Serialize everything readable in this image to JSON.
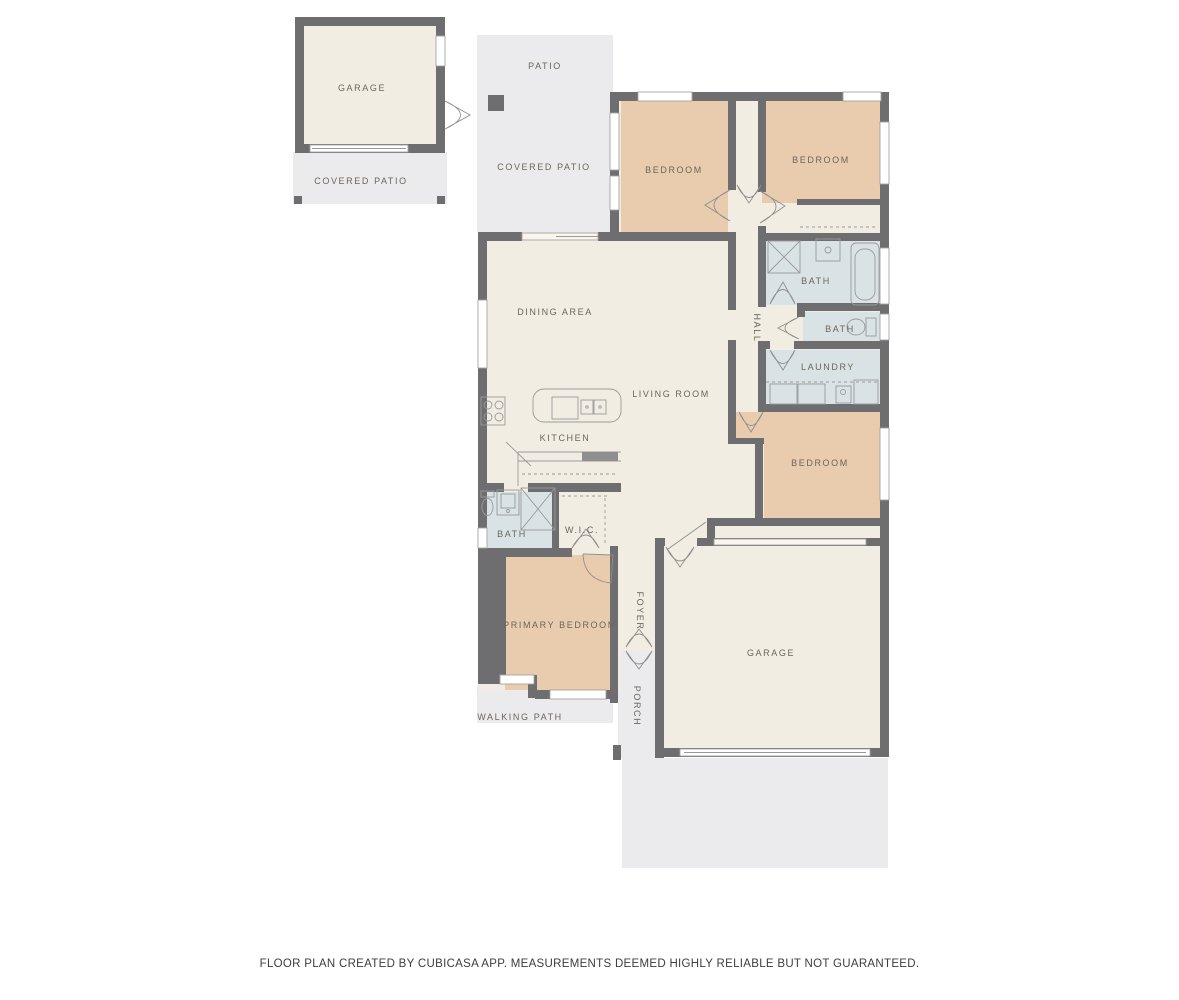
{
  "disclaimer": "FLOOR PLAN CREATED BY CUBICASA APP. MEASUREMENTS DEEMED HIGHLY RELIABLE BUT NOT GUARANTEED.",
  "labels": {
    "detached_garage": "GARAGE",
    "detached_covered_patio": "COVERED PATIO",
    "patio": "PATIO",
    "covered_patio": "COVERED PATIO",
    "bedroom_top_left": "BEDROOM",
    "bedroom_top_right": "BEDROOM",
    "bath_1": "BATH",
    "bath_2": "BATH",
    "laundry": "LAUNDRY",
    "hall": "HALL",
    "dining_area": "DINING AREA",
    "living_room": "LIVING ROOM",
    "kitchen": "KITCHEN",
    "primary_bath": "BATH",
    "wic": "W.I.C.",
    "bedroom_right": "BEDROOM",
    "primary_bedroom": "PRIMARY BEDROOM",
    "foyer": "FOYER",
    "porch": "PORCH",
    "garage": "GARAGE",
    "walking_path": "WALKING PATH"
  },
  "colors": {
    "wall": "#6e6e70",
    "floor_cream": "#f2ede3",
    "room_tan": "#e9cbae",
    "room_blue": "#d9e3e5",
    "outdoor": "#ebebed",
    "window_line": "#a3a3a3",
    "fixture_line": "#9a9a9a",
    "door_line": "#8f8f8f",
    "label_text": "#6c665c",
    "disclaimer_text": "#3d3d3d"
  }
}
